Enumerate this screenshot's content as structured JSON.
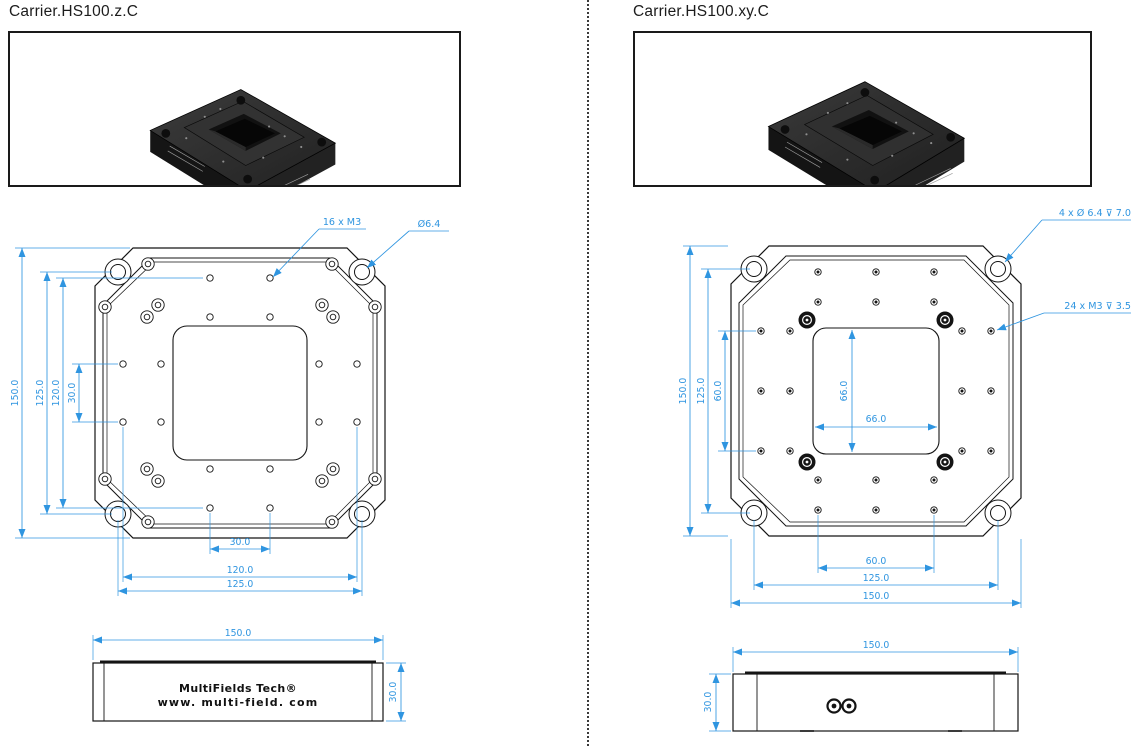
{
  "left": {
    "title": "Carrier.HS100.z.C",
    "photo": {
      "ce": "CE"
    },
    "plan": {
      "label_16m3": "16 x M3",
      "label_dia": "Ø6.4",
      "dim_150": "150.0",
      "dim_125": "125.0",
      "dim_120": "120.0",
      "dim_30": "30.0",
      "dim_b30": "30.0",
      "dim_b120": "120.0",
      "dim_b125": "125.0"
    },
    "side": {
      "dim_w": "150.0",
      "dim_h": "30.0",
      "brand": "MultiFields Tech®",
      "url": "www. multi-field. com"
    }
  },
  "right": {
    "title": "Carrier.HS100.xy.C",
    "photo": {
      "ce": "CE"
    },
    "plan": {
      "label_cbore": "4 x Ø 6.4  ⊽ 7.0",
      "label_24m3": "24 x M3 ⊽ 3.5",
      "dim_150": "150.0",
      "dim_125": "125.0",
      "dim_60": "60.0",
      "dim_66v": "66.0",
      "dim_66h": "66.0",
      "dim_b60": "60.0",
      "dim_b125": "125.0",
      "dim_b150": "150.0"
    },
    "side": {
      "dim_w": "150.0",
      "dim_h": "30.0"
    }
  },
  "colors": {
    "dimension": "#2f95e0",
    "line": "#141414"
  },
  "geometry": {
    "left_plan": {
      "m3": [
        [
          210,
          278
        ],
        [
          270,
          278
        ],
        [
          210,
          317
        ],
        [
          270,
          317
        ],
        [
          123,
          364
        ],
        [
          161,
          364
        ],
        [
          319,
          364
        ],
        [
          357,
          364
        ],
        [
          123,
          422
        ],
        [
          161,
          422
        ],
        [
          319,
          422
        ],
        [
          357,
          422
        ],
        [
          210,
          469
        ],
        [
          270,
          469
        ],
        [
          210,
          508
        ],
        [
          270,
          508
        ]
      ],
      "corner": [
        [
          118,
          272
        ],
        [
          362,
          272
        ],
        [
          118,
          514
        ],
        [
          362,
          514
        ]
      ],
      "screws": [
        [
          148,
          264
        ],
        [
          105,
          307
        ],
        [
          147,
          317
        ],
        [
          158,
          305
        ],
        [
          332,
          264
        ],
        [
          375,
          307
        ],
        [
          333,
          317
        ],
        [
          322,
          305
        ],
        [
          148,
          522
        ],
        [
          105,
          479
        ],
        [
          147,
          469
        ],
        [
          158,
          481
        ],
        [
          332,
          522
        ],
        [
          375,
          479
        ],
        [
          333,
          469
        ],
        [
          322,
          481
        ]
      ]
    },
    "right_plan": {
      "m3": [
        [
          818,
          272
        ],
        [
          876,
          272
        ],
        [
          934,
          272
        ],
        [
          818,
          302
        ],
        [
          876,
          302
        ],
        [
          934,
          302
        ],
        [
          818,
          480
        ],
        [
          876,
          480
        ],
        [
          934,
          480
        ],
        [
          818,
          510
        ],
        [
          876,
          510
        ],
        [
          934,
          510
        ],
        [
          761,
          331
        ],
        [
          761,
          391
        ],
        [
          761,
          451
        ],
        [
          790,
          331
        ],
        [
          790,
          391
        ],
        [
          790,
          451
        ],
        [
          962,
          331
        ],
        [
          962,
          391
        ],
        [
          962,
          451
        ],
        [
          991,
          331
        ],
        [
          991,
          391
        ],
        [
          991,
          451
        ]
      ],
      "corner": [
        [
          754,
          269
        ],
        [
          998,
          269
        ],
        [
          754,
          513
        ],
        [
          998,
          513
        ]
      ],
      "hex": [
        [
          807,
          320
        ],
        [
          945,
          320
        ],
        [
          807,
          462
        ],
        [
          945,
          462
        ]
      ]
    }
  }
}
